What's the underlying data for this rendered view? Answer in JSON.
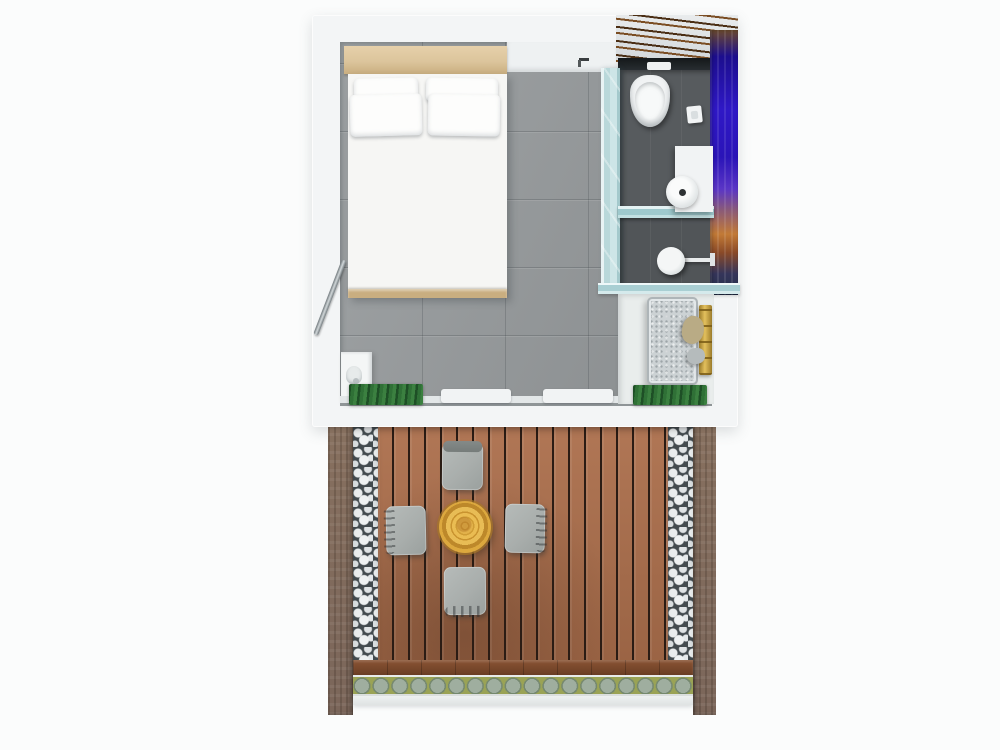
{
  "scene": {
    "description": "3D top-down rendering of a studio guest-room floor plan with en-suite bathroom and a wooden deck terrace",
    "regions": [
      "bedroom",
      "bathroom",
      "utility-nook",
      "terrace"
    ]
  },
  "bedroom": {
    "items": [
      "headboard",
      "double-bed",
      "pillow",
      "pillow",
      "pillow",
      "pillow",
      "grab-rail",
      "wall-unit",
      "wall-hook",
      "sliding-door",
      "door-mat"
    ]
  },
  "bathroom": {
    "items": [
      "photo-mural-wall",
      "cistern-ledge",
      "flush-plate",
      "toilet",
      "toilet-paper-holder",
      "vanity",
      "sink-basin",
      "glass-partition",
      "glass-shelf",
      "rain-shower-head"
    ]
  },
  "utility": {
    "items": [
      "washing-machine",
      "gold-towel-rail",
      "towel",
      "towel",
      "door-mat"
    ]
  },
  "terrace": {
    "items": [
      "stone-wall",
      "pebble-border",
      "timber-deck",
      "log-table",
      "chair",
      "chair",
      "chair",
      "chair",
      "deck-edge-board",
      "planter-row"
    ]
  },
  "colors": {
    "bg": "#fbfcfc",
    "wall": "#f3f5f6",
    "bedroom_floor": "#989c9e",
    "bathroom_floor": "#575b5e",
    "shower_floor": "#515558",
    "glass": "#b9d8da",
    "glass_light": "#e8f3f4",
    "headboard": "#dcc59c",
    "headboard_dark": "#c9ae80",
    "bed": "#f6f6f4",
    "pillow": "#fdfdfc",
    "mural_blue": "#2f18c6",
    "mural_blue_deep": "#1c0e8e",
    "mural_sunset": "#c27a36",
    "mural_dark": "#23304a",
    "driftwood": "#7a4d23",
    "ledge": "#2e3438",
    "fixture": "#f1f3f4",
    "washer": "#ccd2d4",
    "gold": "#e3c05d",
    "towel": "#b9ab85",
    "mat_green": "#2f7036",
    "mat_green_dark": "#1e4f26",
    "deck_plank": "#ac6f4c",
    "deck_gap": "#2b1c14",
    "deck_edge": "#8a5434",
    "pebble_bg": "#434b4f",
    "pebble": "#e9eced",
    "stone_wall": "#87705f",
    "moss": "#9aa355",
    "plant": "#9fae9f",
    "plant_dark": "#75886f",
    "chair": "#a9aeac",
    "chair_dark": "#848a88",
    "stump": "#e6b84e",
    "stump_ring": "#c9932f",
    "track": "#8f9597",
    "sill": "#e3e7e8"
  }
}
